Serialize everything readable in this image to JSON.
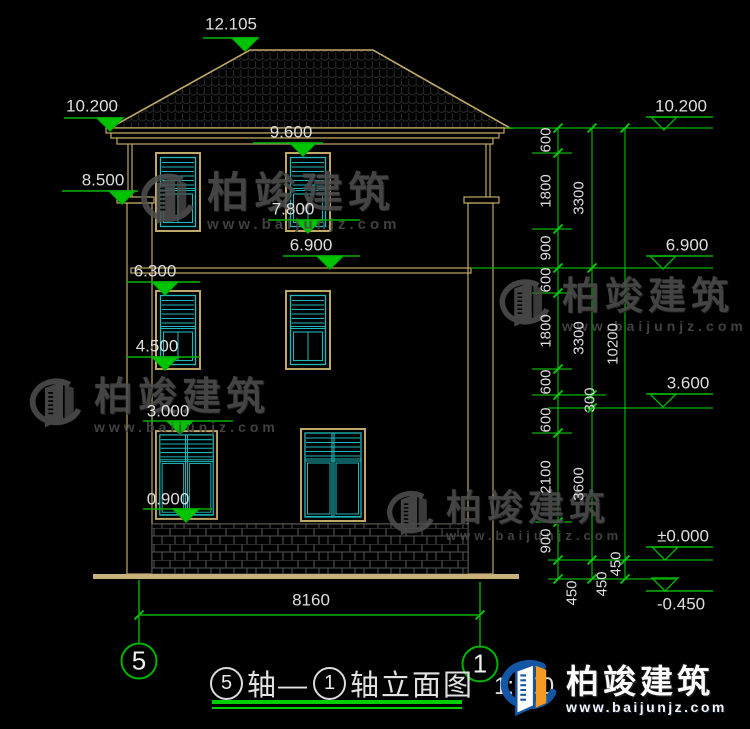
{
  "title": {
    "axis_from": "5",
    "connector": "轴—",
    "axis_to": "1",
    "suffix": "轴立面图",
    "scale": "1:100"
  },
  "axes": {
    "left": "5",
    "right": "1"
  },
  "dimensions": {
    "bottom_width": "8160",
    "levels_left": [
      "12.105",
      "10.200",
      "8.500",
      "9.600",
      "7.800",
      "6.900",
      "6.300",
      "4.500",
      "3.000",
      "0.900"
    ],
    "levels_right": [
      "10.200",
      "6.900",
      "3.600",
      "±0.000",
      "-0.450"
    ],
    "chain_col1": [
      "600",
      "1800",
      "900",
      "600",
      "1800",
      "600",
      "600",
      "2100",
      "900",
      "450"
    ],
    "chain_col2": [
      "3300",
      "3300",
      "300",
      "3600",
      "450"
    ],
    "chain_col3": [
      "10200",
      "450"
    ]
  },
  "watermark": {
    "brand": "柏竣建筑",
    "url": "www.baijunjz.com"
  },
  "brand_logo": {
    "brand": "柏竣建筑",
    "url": "www.baijunjz.com"
  },
  "colors": {
    "background": "#000000",
    "dimension_green": "#00b300",
    "building_tan": "#bfa868",
    "window_cyan": "#1cb8bc",
    "text_white": "#dedede",
    "watermark_gray": "#4e4e4e",
    "logo_blue": "#1456a6",
    "logo_orange": "#f59b22"
  }
}
